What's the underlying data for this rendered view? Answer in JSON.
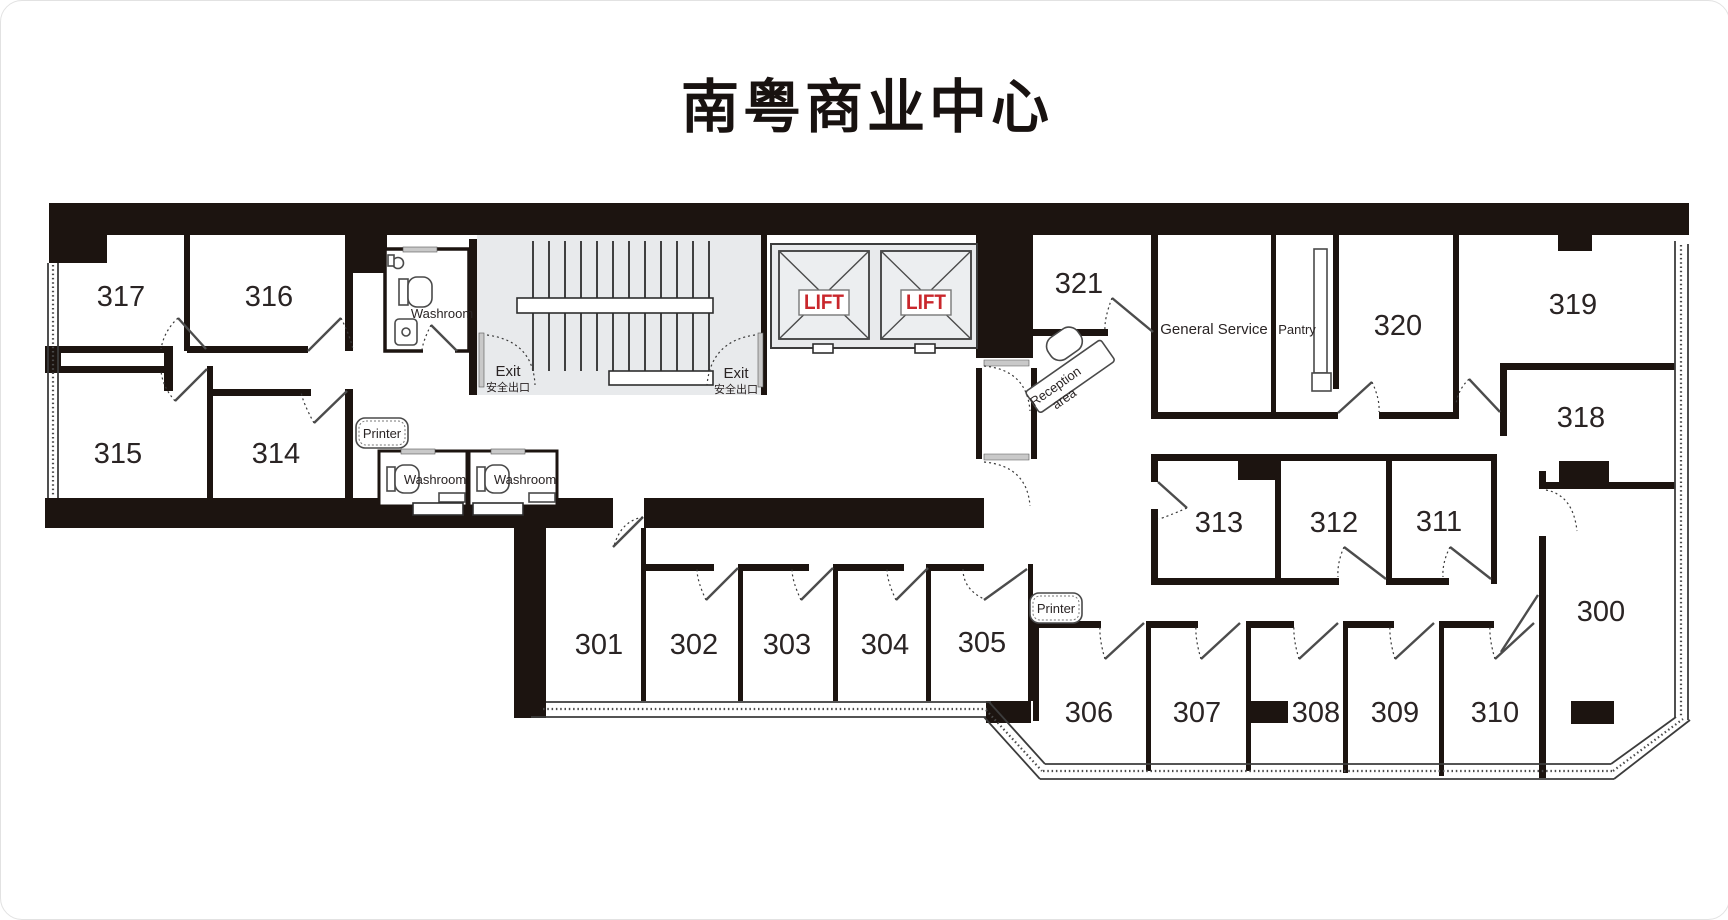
{
  "title": "南粤商业中心",
  "colors": {
    "wall": "#1c1410",
    "stair_fill": "#e8eaec",
    "lift_shaft_fill": "#eceef0",
    "lift_red": "#c9272c",
    "label": "#2a2424"
  },
  "rooms": {
    "r300": "300",
    "r301": "301",
    "r302": "302",
    "r303": "303",
    "r304": "304",
    "r305": "305",
    "r306": "306",
    "r307": "307",
    "r308": "308",
    "r309": "309",
    "r310": "310",
    "r311": "311",
    "r312": "312",
    "r313": "313",
    "r314": "314",
    "r315": "315",
    "r316": "316",
    "r317": "317",
    "r318": "318",
    "r319": "319",
    "r320": "320",
    "r321": "321"
  },
  "labels": {
    "washroom": "Washroom",
    "printer": "Printer",
    "exit_en": "Exit",
    "exit_zh": "安全出口",
    "lift": "LIFT",
    "reception_line1": "Reception",
    "reception_line2": "area",
    "general_service": "General Service",
    "pantry": "Pantry"
  }
}
